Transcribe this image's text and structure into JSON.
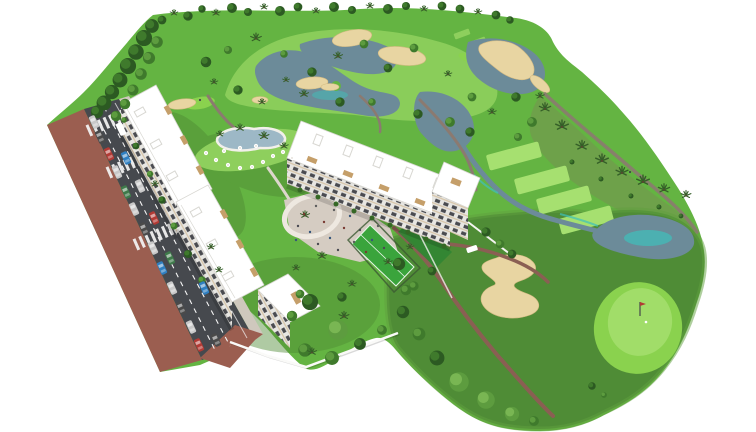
{
  "colors": {
    "background": "#ffffff",
    "course_green": "#64b442",
    "fairway_light": "#8ecf5d",
    "green_bright": "#8ad24e",
    "green_pale": "#a6e070",
    "rough_dark": "#4f8c36",
    "scrub_green": "#6f9e4b",
    "site_green": "#4e8a33",
    "tree_dark": "#2c5a22",
    "tree_mid": "#3f7a2c",
    "tree_light": "#5d9c3f",
    "tree_pale": "#79b653",
    "palm_green": "#355f28",
    "sand": "#e8d5a2",
    "sand_edge": "#d3ba82",
    "water": "#6c8b99",
    "water_teal": "#3fc0ba",
    "cart_path": "#8b7a70",
    "red_path": "#8a5f53",
    "asphalt": "#46494e",
    "lane_white": "#f5f5f5",
    "sidewalk_brick": "#9b5e50",
    "walk_light": "#cfc8bd",
    "building_white": "#ffffff",
    "roof_line": "#d8d7d2",
    "facade_light": "#e7e6e2",
    "window_dark": "#4a4b50",
    "wood": "#c59f6a",
    "plaza_paving": "#d5ccc2",
    "plaza_ring": "#eee8e0",
    "pool_water": "#9db8c6",
    "pool_deck": "#f2f0ea",
    "court_green": "#3aa43c",
    "court_line": "#e8f5e8",
    "fence_dark": "#3c5a33",
    "car_red": "#b23a34",
    "car_blue": "#2f7fc1",
    "car_green": "#3e7a4a",
    "car_silver": "#c8c8c8",
    "car_dark": "#4a4a4a",
    "car_white": "#ffffff",
    "car_teal": "#2e9aa8"
  },
  "scene": {
    "type": "aerial-architectural-render",
    "elements": [
      "golf-course",
      "lakes",
      "teal-pond",
      "sand-bunkers",
      "fairways",
      "putting-green-with-flag",
      "driving-range-targets",
      "cart-paths",
      "apartment-building-row-a",
      "apartment-building-row-b",
      "swimming-pool-with-umbrellas",
      "central-plaza-with-people",
      "padel-court",
      "garden-with-walls",
      "avenue-with-crosswalks",
      "parked-cars",
      "palm-trees"
    ]
  }
}
